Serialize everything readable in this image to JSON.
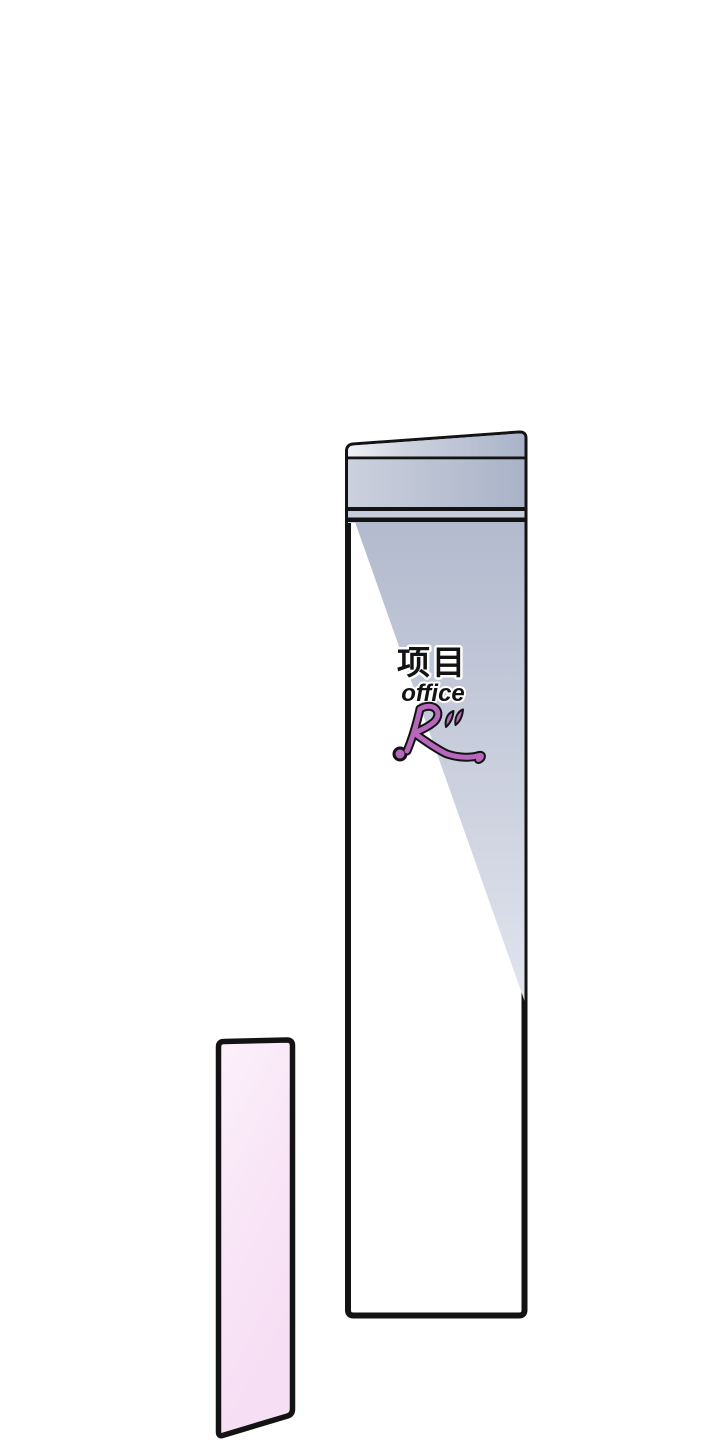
{
  "panel": {
    "background_color": "#ffffff",
    "signboard": {
      "label_cn": "项目",
      "label_en": "office",
      "logo_text": "R”",
      "colors": {
        "outline": "#131313",
        "face": "#ffffff",
        "shade_top": "#aab3c8",
        "shade_mid": "#ccd1df",
        "shade_light": "#e3e6ee",
        "divider_gap": "#c6ccda",
        "logo_purple": "#b768bd"
      }
    },
    "side_panel": {
      "colors": {
        "outline": "#131313",
        "fill_light": "#fcf1fb",
        "fill_pink": "#f6def4"
      }
    }
  }
}
